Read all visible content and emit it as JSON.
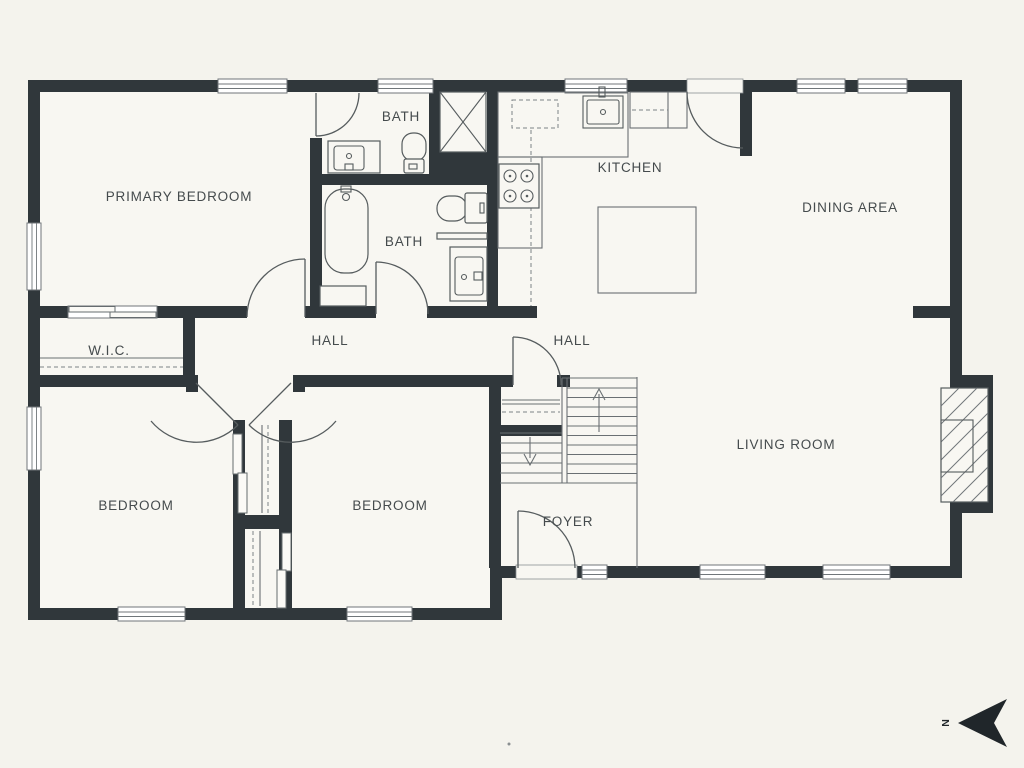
{
  "floorplan": {
    "colors": {
      "background": "#f4f3ed",
      "room_fill": "#f8f7f2",
      "wall": "#30373b",
      "line": "#6a7073",
      "text": "#454b4d"
    },
    "rooms": {
      "primary_bedroom": "PRIMARY BEDROOM",
      "bath_upper": "BATH",
      "bath_lower": "BATH",
      "kitchen": "KITCHEN",
      "dining_area": "DINING AREA",
      "wic": "W.I.C.",
      "hall_bedrooms": "HALL",
      "hall_main": "HALL",
      "living_room": "LIVING ROOM",
      "bedroom_left": "BEDROOM",
      "bedroom_middle": "BEDROOM",
      "foyer": "FOYER"
    },
    "compass": {
      "letter": "N",
      "pointing": "left"
    }
  }
}
